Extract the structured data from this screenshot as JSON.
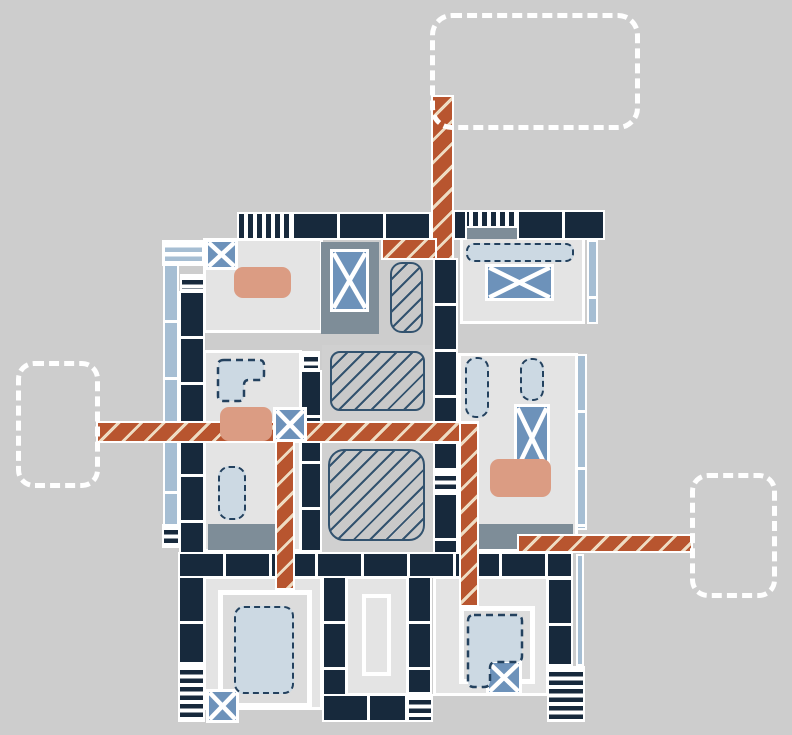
{
  "canvas": {
    "width": 792,
    "height": 735,
    "background": "#cdcdcd"
  },
  "colors": {
    "navy": "#17293c",
    "orange": "#b8552f",
    "cream": "#eedcc3",
    "slate": "#7e8d98",
    "steel": "#6d92ba",
    "pale": "#a6bed3",
    "dashfill": "#ccd9e3",
    "dashstroke": "#23415e",
    "salmon": "#db9c83",
    "room": "#e4e4e4",
    "innerg": "#dcdcdc",
    "centerg": "#d0d0d0",
    "hatchfill": "#c9c9c9",
    "hatchline": "#33536f"
  },
  "elements": [
    {
      "name": "room-top-left",
      "type": "room",
      "x": 203,
      "y": 238,
      "w": 120,
      "h": 95
    },
    {
      "name": "room-top-right",
      "type": "room",
      "x": 460,
      "y": 236,
      "w": 125,
      "h": 88
    },
    {
      "name": "room-middle-left",
      "type": "room",
      "x": 203,
      "y": 350,
      "w": 99,
      "h": 202
    },
    {
      "name": "room-center-column",
      "type": "roomplain",
      "x": 322,
      "y": 345,
      "w": 111,
      "h": 207
    },
    {
      "name": "room-middle-right",
      "type": "room",
      "x": 458,
      "y": 353,
      "w": 120,
      "h": 199
    },
    {
      "name": "room-bottom-left",
      "type": "room",
      "x": 203,
      "y": 576,
      "w": 120,
      "h": 134
    },
    {
      "name": "room-bottom-middle",
      "type": "room",
      "x": 345,
      "y": 576,
      "w": 64,
      "h": 120
    },
    {
      "name": "room-bottom-right",
      "type": "room",
      "x": 433,
      "y": 576,
      "w": 116,
      "h": 120
    },
    {
      "name": "inner-room-bottom-left",
      "type": "inner",
      "x": 218,
      "y": 590,
      "w": 94,
      "h": 118
    },
    {
      "name": "inner-room-bottom-right",
      "type": "inner",
      "x": 459,
      "y": 606,
      "w": 76,
      "h": 78
    },
    {
      "name": "white-outline-rect",
      "type": "outline",
      "x": 362,
      "y": 594,
      "w": 29,
      "h": 82
    },
    {
      "name": "slate-room",
      "type": "slate",
      "x": 321,
      "y": 242,
      "w": 58,
      "h": 92
    },
    {
      "name": "slate-band-top-right",
      "type": "slate",
      "x": 462,
      "y": 228,
      "w": 121,
      "h": 11
    },
    {
      "name": "slate-band-mid-left",
      "type": "slate",
      "x": 208,
      "y": 524,
      "w": 67,
      "h": 26
    },
    {
      "name": "slate-band-mid-right",
      "type": "slate",
      "x": 479,
      "y": 524,
      "w": 94,
      "h": 25
    },
    {
      "name": "window-band-left",
      "type": "windowseg",
      "x": 163,
      "y": 264,
      "w": 16,
      "h": 282
    },
    {
      "name": "window-band-top-right",
      "type": "windowseg",
      "x": 587,
      "y": 240,
      "w": 11,
      "h": 84
    },
    {
      "name": "window-band-mid-right",
      "type": "windowseg",
      "x": 576,
      "y": 354,
      "w": 11,
      "h": 176
    },
    {
      "name": "window-band-bottom-right",
      "type": "window",
      "x": 576,
      "y": 554,
      "w": 8,
      "h": 112
    },
    {
      "name": "window-box-corner",
      "type": "windowbox",
      "x": 162,
      "y": 240,
      "w": 43,
      "h": 26
    },
    {
      "name": "wall-top-hatched-left",
      "type": "hatchdense",
      "x": 237,
      "y": 212,
      "w": 55,
      "h": 28
    },
    {
      "name": "wall-top-left",
      "type": "wallh",
      "x": 292,
      "y": 212,
      "w": 140,
      "h": 28
    },
    {
      "name": "wall-top-hatched-right",
      "type": "hatchdense",
      "x": 462,
      "y": 210,
      "w": 55,
      "h": 18
    },
    {
      "name": "wall-top-right",
      "type": "wallh",
      "x": 517,
      "y": 210,
      "w": 88,
      "h": 30
    },
    {
      "name": "wall-top-stub",
      "type": "wallv",
      "x": 453,
      "y": 210,
      "w": 14,
      "h": 30
    },
    {
      "name": "door-stripes-left-top",
      "type": "stripesh",
      "x": 180,
      "y": 274,
      "w": 25,
      "h": 17
    },
    {
      "name": "wall-left",
      "type": "wallv",
      "x": 179,
      "y": 291,
      "w": 26,
      "h": 264
    },
    {
      "name": "door-stripes-left-band",
      "type": "stripesh",
      "x": 162,
      "y": 524,
      "w": 18,
      "h": 24
    },
    {
      "name": "wall-left-lower",
      "type": "wallv",
      "x": 178,
      "y": 576,
      "w": 27,
      "h": 88
    },
    {
      "name": "door-stripes-left-lower",
      "type": "stripesh",
      "x": 178,
      "y": 664,
      "w": 27,
      "h": 58
    },
    {
      "name": "door-stripes-mid-column",
      "type": "stripesh",
      "x": 302,
      "y": 351,
      "w": 18,
      "h": 19
    },
    {
      "name": "wall-mid-column",
      "type": "wallv",
      "x": 300,
      "y": 370,
      "w": 22,
      "h": 182
    },
    {
      "name": "wall-spine-upper",
      "type": "wallv",
      "x": 433,
      "y": 258,
      "w": 25,
      "h": 212
    },
    {
      "name": "door-stripes-spine",
      "type": "stripesh",
      "x": 433,
      "y": 470,
      "w": 25,
      "h": 23
    },
    {
      "name": "wall-spine-lower",
      "type": "wallv",
      "x": 433,
      "y": 493,
      "w": 25,
      "h": 83
    },
    {
      "name": "wall-bottom-row",
      "type": "wallh",
      "x": 178,
      "y": 552,
      "w": 395,
      "h": 26
    },
    {
      "name": "wall-bottom-left-column",
      "type": "wallv",
      "x": 322,
      "y": 576,
      "w": 25,
      "h": 120
    },
    {
      "name": "wall-bottom-left-row",
      "type": "wallh",
      "x": 322,
      "y": 694,
      "w": 85,
      "h": 28
    },
    {
      "name": "door-stripes-bottom-mid",
      "type": "stripesh",
      "x": 407,
      "y": 694,
      "w": 26,
      "h": 28
    },
    {
      "name": "wall-bottom-mid-column",
      "type": "wallv",
      "x": 407,
      "y": 576,
      "w": 25,
      "h": 118
    },
    {
      "name": "wall-bottom-right-column",
      "type": "wallv",
      "x": 547,
      "y": 578,
      "w": 26,
      "h": 88
    },
    {
      "name": "door-stripes-bottom-right",
      "type": "stripesh",
      "x": 547,
      "y": 666,
      "w": 38,
      "h": 56
    },
    {
      "name": "corridor-top-vertical",
      "type": "corridor",
      "x": 433,
      "y": 97,
      "w": 19,
      "h": 161
    },
    {
      "name": "corridor-top-horizontal",
      "type": "corridor",
      "x": 383,
      "y": 240,
      "w": 52,
      "h": 18
    },
    {
      "name": "corridor-main-horizontal",
      "type": "corridor",
      "x": 98,
      "y": 423,
      "w": 379,
      "h": 18
    },
    {
      "name": "corridor-center-vertical",
      "type": "corridor",
      "x": 277,
      "y": 420,
      "w": 16,
      "h": 168
    },
    {
      "name": "corridor-right-vertical",
      "type": "corridor",
      "x": 461,
      "y": 424,
      "w": 16,
      "h": 181
    },
    {
      "name": "corridor-right-horizontal",
      "type": "corridor",
      "x": 519,
      "y": 536,
      "w": 172,
      "h": 15
    },
    {
      "name": "hatch-zone-tall",
      "type": "hatchroom",
      "x": 390,
      "y": 262,
      "w": 33,
      "h": 71,
      "r": 12
    },
    {
      "name": "hatch-zone-middle",
      "type": "hatchroom",
      "x": 330,
      "y": 351,
      "w": 95,
      "h": 60,
      "r": 10
    },
    {
      "name": "hatch-zone-large",
      "type": "hatchroom",
      "x": 328,
      "y": 449,
      "w": 97,
      "h": 92,
      "r": 16
    },
    {
      "name": "xbox-top-left-corner",
      "type": "xbox",
      "x": 205,
      "y": 239,
      "w": 33,
      "h": 31
    },
    {
      "name": "xbox-slate-room",
      "type": "xbox",
      "x": 330,
      "y": 249,
      "w": 39,
      "h": 63
    },
    {
      "name": "xbox-top-right",
      "type": "xbox",
      "x": 485,
      "y": 264,
      "w": 69,
      "h": 37
    },
    {
      "name": "xbox-mid-left",
      "type": "xbox",
      "x": 273,
      "y": 407,
      "w": 34,
      "h": 35
    },
    {
      "name": "xbox-mid-right",
      "type": "xbox",
      "x": 514,
      "y": 404,
      "w": 36,
      "h": 68
    },
    {
      "name": "xbox-bottom-left",
      "type": "xbox",
      "x": 206,
      "y": 689,
      "w": 33,
      "h": 34
    },
    {
      "name": "xbox-bottom-right",
      "type": "xbox",
      "x": 486,
      "y": 660,
      "w": 36,
      "h": 35
    },
    {
      "name": "salmon-rug-top-left",
      "type": "salmon",
      "x": 234,
      "y": 267,
      "w": 57,
      "h": 31,
      "r": 9
    },
    {
      "name": "salmon-rug-mid-left",
      "type": "salmon",
      "x": 220,
      "y": 407,
      "w": 52,
      "h": 34,
      "r": 9
    },
    {
      "name": "salmon-rug-mid-right",
      "type": "salmon",
      "x": 490,
      "y": 459,
      "w": 61,
      "h": 38,
      "r": 9
    },
    {
      "name": "dashed-item-top-right",
      "type": "dashed",
      "x": 466,
      "y": 243,
      "w": 108,
      "h": 19,
      "r": 8
    },
    {
      "name": "dashed-item-mid-left-small",
      "type": "dashed",
      "x": 218,
      "y": 466,
      "w": 28,
      "h": 54,
      "r": 11
    },
    {
      "name": "dashed-item-mid-right-1",
      "type": "dashed",
      "x": 465,
      "y": 357,
      "w": 24,
      "h": 61,
      "r": 11
    },
    {
      "name": "dashed-item-mid-right-2",
      "type": "dashed",
      "x": 520,
      "y": 358,
      "w": 24,
      "h": 43,
      "r": 11
    },
    {
      "name": "dashed-item-bottom-left",
      "type": "dashed",
      "x": 234,
      "y": 606,
      "w": 60,
      "h": 88,
      "r": 10
    },
    {
      "name": "dashed-lshape-mid-left",
      "type": "path",
      "x": 217,
      "y": 359,
      "w": 48,
      "h": 44,
      "d": "M7,1 H42 Q47,1 47,6 V16 Q47,21 42,21 H32 Q27,21 27,26 V37 Q27,42 22,42 H7 Q1,42 1,37 V6 Q1,1 7,1 Z"
    },
    {
      "name": "dashed-pshape-bottom-right",
      "type": "path",
      "x": 467,
      "y": 614,
      "w": 57,
      "h": 75,
      "d": "M7,1 H49 Q55,1 55,7 V42 Q55,48 49,48 H29 Q23,48 23,54 V67 Q23,73 17,73 H7 Q1,73 1,67 V7 Q1,1 7,1 Z"
    },
    {
      "name": "callout-placeholder-top",
      "type": "callout",
      "x": 430,
      "y": 13,
      "w": 210,
      "h": 117,
      "r": 22,
      "interactable": true
    },
    {
      "name": "callout-placeholder-left",
      "type": "callout",
      "x": 16,
      "y": 361,
      "w": 84,
      "h": 127,
      "r": 18,
      "interactable": true
    },
    {
      "name": "callout-placeholder-right",
      "type": "callout",
      "x": 690,
      "y": 473,
      "w": 87,
      "h": 125,
      "r": 18,
      "interactable": true
    }
  ]
}
